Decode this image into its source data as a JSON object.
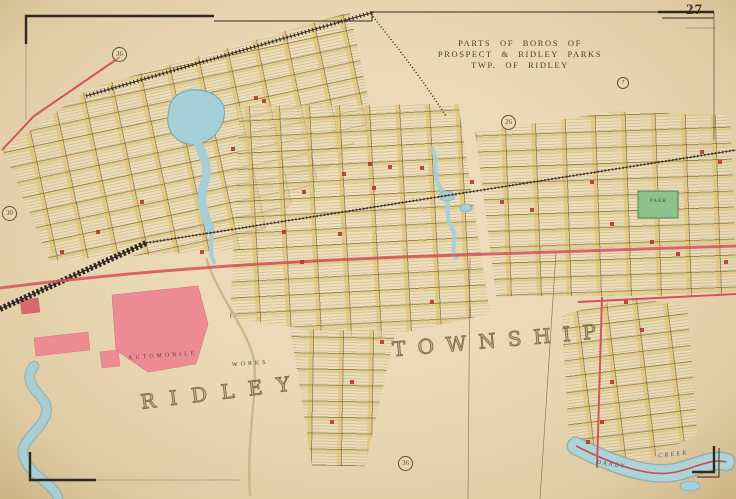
{
  "page": {
    "number": "27"
  },
  "title": {
    "line1": "PARTS OF BOROS OF",
    "line2": "PROSPECT & RIDLEY PARKS",
    "line3": "TWP. OF RIDLEY"
  },
  "map": {
    "township_word1": "RIDLEY",
    "township_word2": "TOWNSHIP",
    "automobile_label": "AUTOMOBILE",
    "works_label": "WORKS",
    "park_label": "PARK",
    "creek_word1": "DARBY",
    "creek_word2": "CREEK",
    "plate_refs": [
      {
        "value": "36"
      },
      {
        "value": "26"
      },
      {
        "value": "30"
      },
      {
        "value": "36"
      },
      {
        "value": "7"
      }
    ],
    "colors": {
      "paper": "#e9d8b4",
      "water": "#a6ced6",
      "road_red": "#d4545c",
      "factory_pink": "#ec8c92",
      "park_green": "#8cc28b",
      "railroad_ink": "#3a3226",
      "ink": "#4c4330"
    }
  }
}
